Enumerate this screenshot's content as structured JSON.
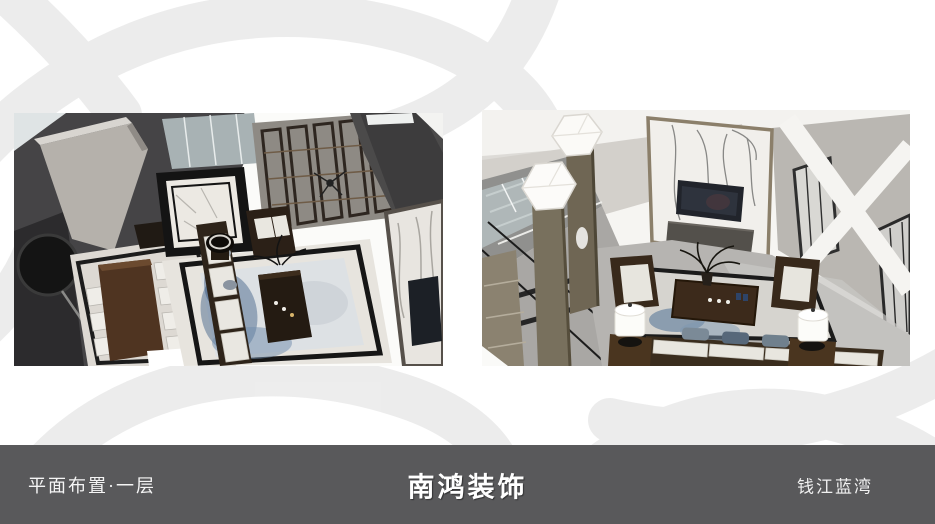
{
  "slide": {
    "background_color": "#ffffff",
    "watermark": {
      "name": "brand-logo-watermark",
      "color": "#ececec"
    },
    "renders": {
      "left": {
        "alt": "鸟瞰渲染图：一层客厅与餐厅，中式深色木家具、蓝白地毯、大理石地面、黑色团扇挂饰"
      },
      "right": {
        "alt": "鸟瞰渲染图：一层客厅电视大理石背景墙、楼梯、白色灯柱与中式沙发组"
      }
    },
    "footer": {
      "bar_color": "#59595b",
      "text_color": "#fbfbfb",
      "left_label": "平面布置·一层",
      "center_label": "南鸿装饰",
      "right_label": "钱江蓝湾"
    }
  }
}
